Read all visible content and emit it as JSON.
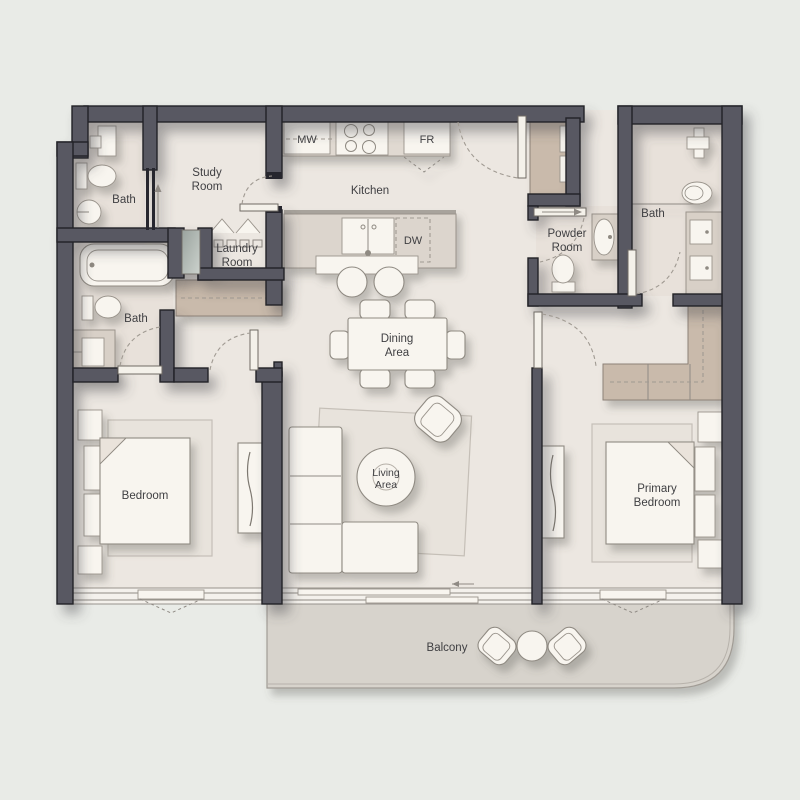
{
  "plan": {
    "rooms": {
      "bath_top_left": {
        "label": "Bath"
      },
      "study": {
        "line1": "Study",
        "line2": "Room"
      },
      "kitchen": {
        "label": "Kitchen"
      },
      "laundry": {
        "line1": "Laundry",
        "line2": "Room"
      },
      "bath_left": {
        "label": "Bath"
      },
      "powder": {
        "line1": "Powder",
        "line2": "Room"
      },
      "bath_right": {
        "label": "Bath"
      },
      "dining": {
        "line1": "Dining",
        "line2": "Area"
      },
      "living": {
        "line1": "Living",
        "line2": "Area"
      },
      "bedroom": {
        "label": "Bedroom"
      },
      "primary": {
        "line1": "Primary",
        "line2": "Bedroom"
      },
      "balcony": {
        "label": "Balcony"
      }
    },
    "appliances": {
      "microwave": "MW",
      "fridge": "FR",
      "dishwasher": "DW"
    },
    "colors": {
      "background": "#e9ebe7",
      "wall": "#585862",
      "floor": "#ece7e1",
      "balcony_floor": "#d7d3cc",
      "wardrobe": "#c9baab",
      "furniture": "#f8f5ef"
    }
  }
}
